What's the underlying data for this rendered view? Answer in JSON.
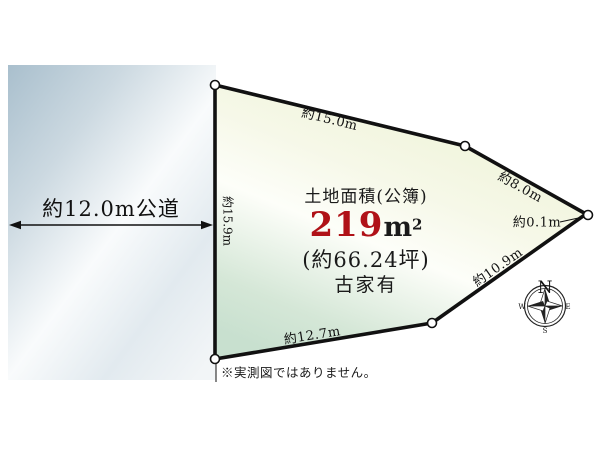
{
  "diagram": {
    "road": {
      "width_label": "約12.0m公道",
      "frontage_label": "約15.9m"
    },
    "plot": {
      "area_title": "土地面積(公簿)",
      "area_number": "219",
      "area_unit": "m",
      "area_exponent": "2",
      "area_tsubo": "(約66.24坪)",
      "building_status": "古家有",
      "edge_labels": {
        "top": "約15.0m",
        "upper_right": "約8.0m",
        "right_corner": "約0.1m",
        "lower_right": "約10.9m",
        "bottom": "約12.7m"
      }
    },
    "compass": {
      "north": "N",
      "east": "E",
      "west": "W",
      "south": "S"
    },
    "footnote": "※実測図ではありません。"
  },
  "colors": {
    "area_number_red": "#b01218",
    "outline_black": "#111111",
    "road_blue": "#aec3d0",
    "plot_green": "#c9e1cf",
    "plot_yellow": "#edf2d5"
  }
}
